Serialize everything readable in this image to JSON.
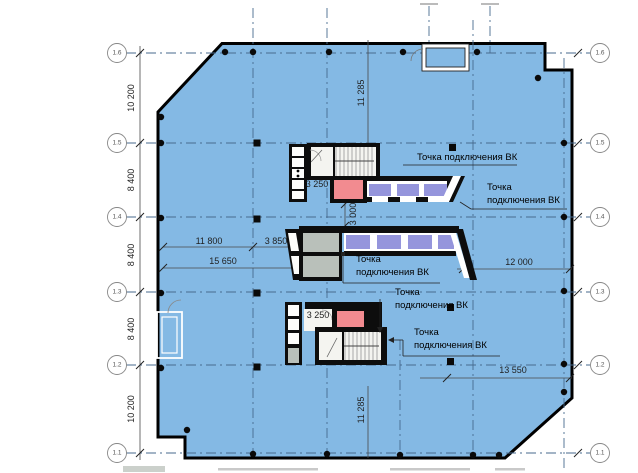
{
  "axes": {
    "left": [
      "1.6",
      "1.5",
      "1.4",
      "1.3",
      "1.2",
      "1.1"
    ],
    "right": [
      "1.6",
      "1.5",
      "1.4",
      "1.3",
      "1.2",
      "1.1"
    ]
  },
  "dimensions": {
    "left_bays": [
      "10 200",
      "8 400",
      "8 400",
      "8 400",
      "10 200"
    ],
    "bay_width_top": "11 285",
    "bay_width_bottom": "11 285",
    "core_offset": "11 800",
    "core_width": "3 850",
    "core_total": "15 650",
    "shaft_top": "3 250",
    "shaft_bottom": "3 250",
    "core_gap": "3 000",
    "right_span": "12 000",
    "bottom_span": "13 550"
  },
  "labels": {
    "connection_full": "Точка подключения ВК",
    "connection_line1": "Точка",
    "connection_line2": "подключения ВК"
  },
  "colors": {
    "floor": "#84b9e4",
    "elevator": "#9595dc",
    "shaft-pink": "#f28b90",
    "room-gray": "#b9c0ba",
    "grid": "#476a8e",
    "wall": "#0d0d0d"
  }
}
